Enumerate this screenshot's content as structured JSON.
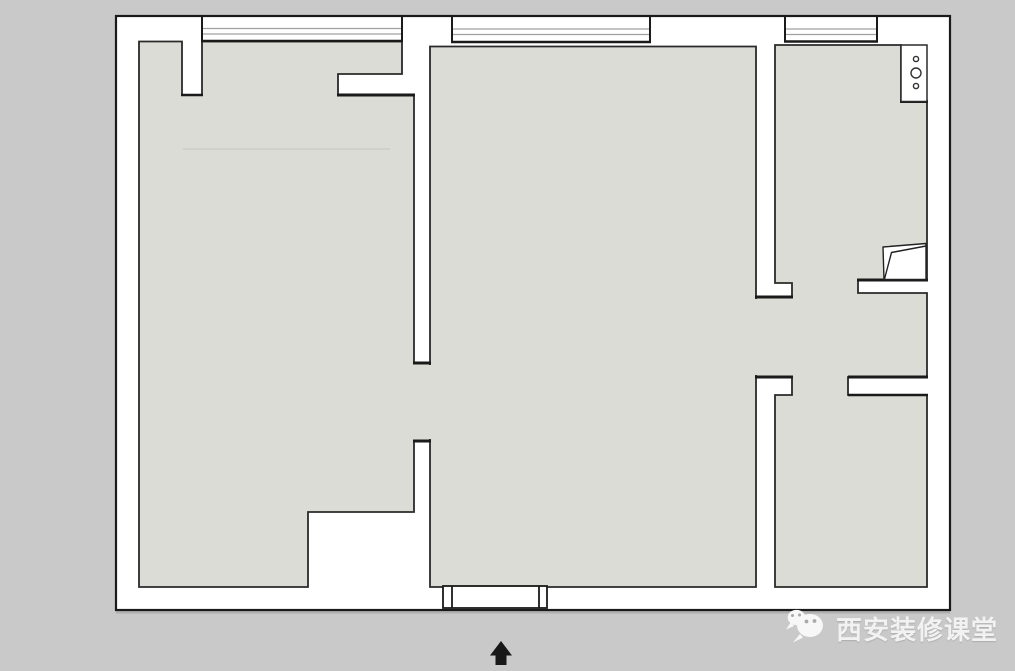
{
  "watermark": {
    "brand_text": "西安装修课堂",
    "icon": "wechat-icon"
  },
  "compass": {
    "icon": "north-arrow-icon",
    "direction": "north"
  },
  "icons": {
    "wechat": "wechat-icon",
    "north_arrow": "north-arrow-icon",
    "wall_fixture": "wall-fixture-icon",
    "cabinet_door": "cabinet-door-symbol"
  },
  "colors": {
    "background": "#c9c9c9",
    "wall_fill": "#ffffff",
    "floor_fill": "#dcdcd6",
    "outline": "#2a2a2a",
    "outline_heavy": "#1a1a1a",
    "window_mullion": "#a0a0a0",
    "watermark_text": "#f2f2f2"
  }
}
